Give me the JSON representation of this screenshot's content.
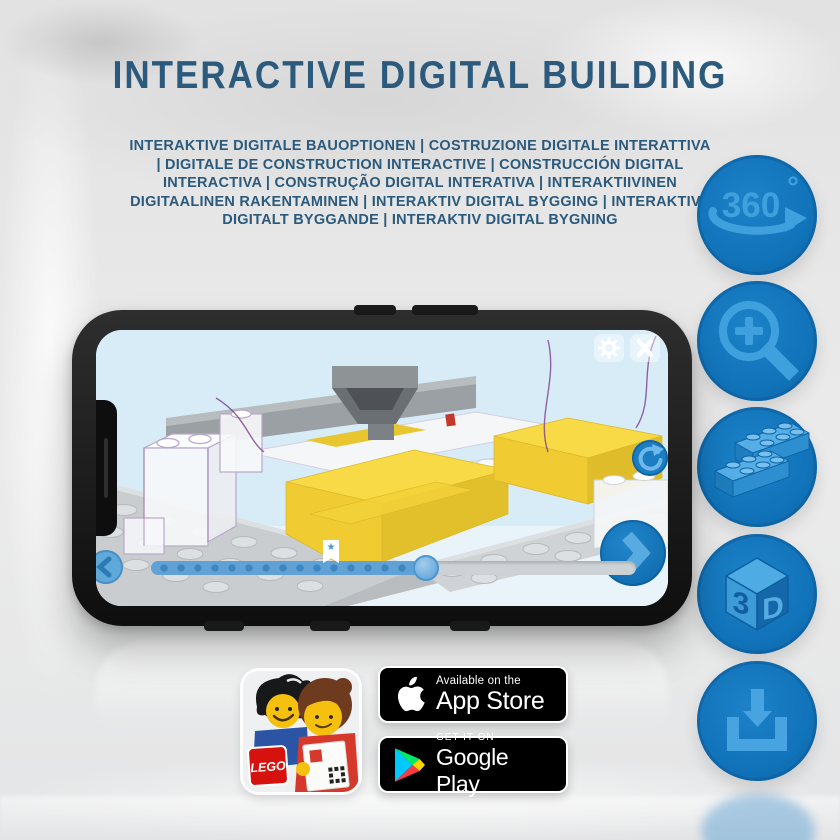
{
  "header": {
    "title": "INTERACTIVE DIGITAL BUILDING",
    "subtitle": "INTERAKTIVE DIGITALE BAUOPTIONEN | COSTRUZIONE DIGITALE INTERATTIVA | DIGITALE DE CONSTRUCTION INTERACTIVE | CONSTRUCCIÓN DIGITAL INTERACTIVA | CONSTRUÇÃO DIGITAL INTERATIVA | INTERAKTIIVINEN DIGITAALINEN RAKENTAMINEN | INTERAKTIV DIGITAL BYGGING | INTERAKTIVT DIGITALT BYGGANDE | INTERAKTIV DIGITAL BYGNING",
    "text_color": "#2b5a7c"
  },
  "features": {
    "items": [
      {
        "id": "360-rotation"
      },
      {
        "id": "zoom-in"
      },
      {
        "id": "brick-building-options"
      },
      {
        "id": "3d-view"
      },
      {
        "id": "download"
      }
    ],
    "rotate_label": "360",
    "rotate_degree": "°",
    "cube_left": "3",
    "cube_right": "D",
    "circle_color": "#1173b9",
    "icon_color": "#3fa0de"
  },
  "phone_ui": {
    "progress_fill_pct": 57,
    "marker_pct": 37,
    "marker_glyph": "★",
    "screen_bg": "#d8ecf8",
    "accent_blue": "#1a7ac0"
  },
  "badges": {
    "app_store": {
      "line1": "Available on the",
      "line2": "App Store"
    },
    "google_play": {
      "line1": "GET IT ON",
      "line2": "Google Play"
    }
  },
  "app_icon": {
    "logo": "LEGO"
  },
  "colors": {
    "yellow_brick": "#f7da45",
    "plate_gray": "#c9cdd0",
    "outline_purple": "#8a5e9c"
  }
}
